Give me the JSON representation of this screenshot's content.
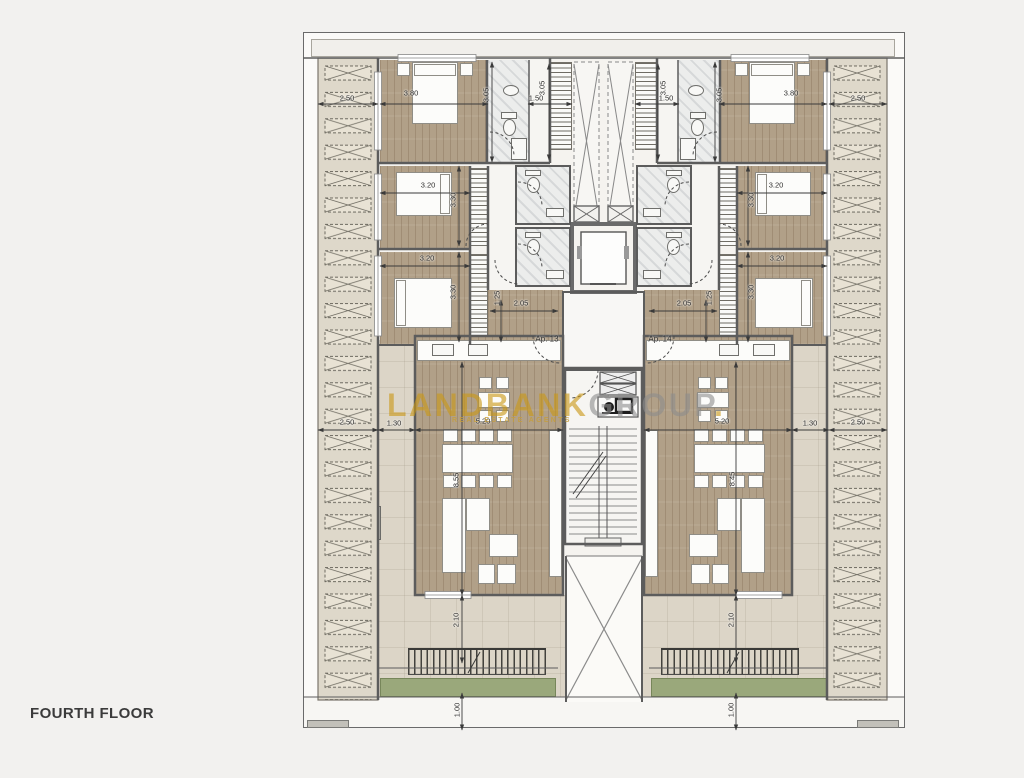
{
  "title": "FOURTH FLOOR",
  "watermark": {
    "brand_primary": "LANDBANK",
    "brand_secondary": "GROUP",
    "brand_dot": ".",
    "tagline": "REAL ESTATE AGENTS"
  },
  "apartments": [
    {
      "label": "Ap. 13"
    },
    {
      "label": "Ap. 14"
    }
  ],
  "colors": {
    "wood_floor": "#b1a088",
    "terrace_tile": "#dcd5c7",
    "planter_green": "#9aa87b",
    "louver_beige": "#ded8ca",
    "wall_gray": "#5c5c5c",
    "brand_gold": "#c99816",
    "brand_gray": "#8c8c8c",
    "background": "#f2f1ef"
  },
  "dimensions": [
    {
      "v": "2.50",
      "x": 347,
      "y": 98,
      "r": 0
    },
    {
      "v": "3.80",
      "x": 411,
      "y": 93,
      "r": 0
    },
    {
      "v": "1.50",
      "x": 536,
      "y": 98,
      "r": 0
    },
    {
      "v": "1.50",
      "x": 666,
      "y": 98,
      "r": 0
    },
    {
      "v": "3.80",
      "x": 791,
      "y": 93,
      "r": 0
    },
    {
      "v": "2.50",
      "x": 858,
      "y": 98,
      "r": 0
    },
    {
      "v": "3.20",
      "x": 428,
      "y": 185,
      "r": 0
    },
    {
      "v": "3.20",
      "x": 776,
      "y": 185,
      "r": 0
    },
    {
      "v": "3.20",
      "x": 427,
      "y": 258,
      "r": 0
    },
    {
      "v": "3.20",
      "x": 777,
      "y": 258,
      "r": 0
    },
    {
      "v": "2.05",
      "x": 521,
      "y": 303,
      "r": 0
    },
    {
      "v": "2.05",
      "x": 684,
      "y": 303,
      "r": 0
    },
    {
      "v": "2.50",
      "x": 347,
      "y": 422,
      "r": 0
    },
    {
      "v": "1.30",
      "x": 394,
      "y": 423,
      "r": 0
    },
    {
      "v": "5.20",
      "x": 483,
      "y": 421,
      "r": 0
    },
    {
      "v": "5.20",
      "x": 722,
      "y": 421,
      "r": 0
    },
    {
      "v": "1.30",
      "x": 810,
      "y": 423,
      "r": 0
    },
    {
      "v": "2.50",
      "x": 858,
      "y": 422,
      "r": 0
    },
    {
      "v": "3.05",
      "x": 486,
      "y": 95,
      "r": -90
    },
    {
      "v": "3.05",
      "x": 542,
      "y": 88,
      "r": -90
    },
    {
      "v": "3.05",
      "x": 663,
      "y": 88,
      "r": -90
    },
    {
      "v": "3.05",
      "x": 719,
      "y": 95,
      "r": -90
    },
    {
      "v": "3.30",
      "x": 453,
      "y": 200,
      "r": -90
    },
    {
      "v": "3.30",
      "x": 751,
      "y": 200,
      "r": -90
    },
    {
      "v": "3.30",
      "x": 453,
      "y": 292,
      "r": -90
    },
    {
      "v": "3.30",
      "x": 751,
      "y": 292,
      "r": -90
    },
    {
      "v": "1.25",
      "x": 497,
      "y": 298,
      "r": -90
    },
    {
      "v": "1.25",
      "x": 709,
      "y": 298,
      "r": -90
    },
    {
      "v": "8.55",
      "x": 456,
      "y": 480,
      "r": -90
    },
    {
      "v": "8.45",
      "x": 732,
      "y": 479,
      "r": -90
    },
    {
      "v": "2.10",
      "x": 456,
      "y": 620,
      "r": -90
    },
    {
      "v": "2.10",
      "x": 731,
      "y": 620,
      "r": -90
    },
    {
      "v": "1.00",
      "x": 457,
      "y": 710,
      "r": -90
    },
    {
      "v": "1.00",
      "x": 731,
      "y": 710,
      "r": -90
    }
  ]
}
